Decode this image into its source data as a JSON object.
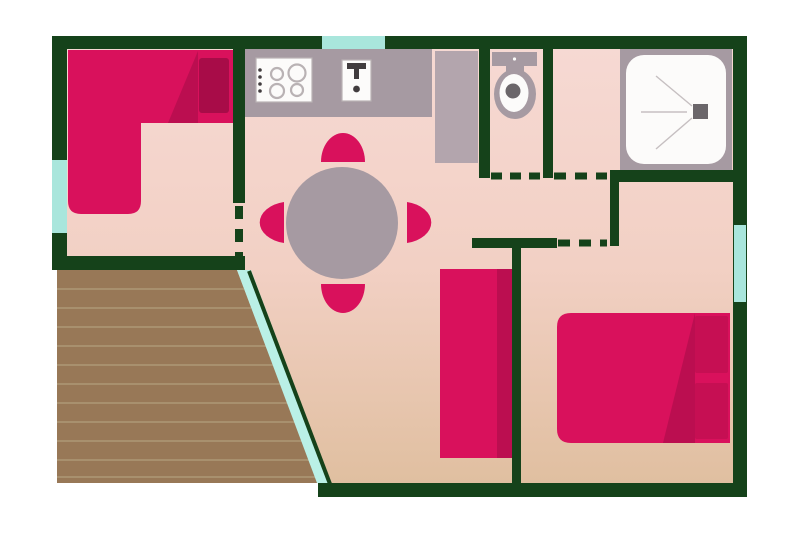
{
  "page": {
    "kind": "floor-plan-illustration"
  },
  "palette": {
    "background": "#ffffff",
    "wall": "#15421a",
    "floor_top": "#f6d9d3",
    "floor_mid": "#f2d0c4",
    "floor_bottom": "#e0bfa0",
    "window_teal": "#a9e6dc",
    "terrace_edge_teal": "#baf0e6",
    "terrace_wood": "#987857",
    "terrace_plank_line": "#a8906e",
    "furniture_primary": "#d9115c",
    "furniture_shade": "#bb0e50",
    "furniture_dark": "#a80c48",
    "pillow_dark": "#c60f53",
    "fixture_gray": "#a69aa2",
    "appliance_gray": "#b3a5ad",
    "fixture_white": "#fcfbfa",
    "fixture_outline": "#b9b2b4",
    "fixture_dark": "#413c3e",
    "drain_gray": "#6b666a",
    "shower_line": "#c6bfc1"
  },
  "plan": {
    "rooms": [
      {
        "name": "bedroom-left"
      },
      {
        "name": "kitchen-living-dining"
      },
      {
        "name": "toilet-room"
      },
      {
        "name": "shower-room"
      },
      {
        "name": "bedroom-right"
      },
      {
        "name": "terrace"
      }
    ],
    "furniture": [
      {
        "name": "corner-sofa-bed"
      },
      {
        "name": "wardrobe"
      },
      {
        "name": "double-bed"
      },
      {
        "name": "dining-table"
      },
      {
        "name": "chairs",
        "count": 4
      }
    ],
    "fixtures": [
      {
        "name": "stove"
      },
      {
        "name": "sink"
      },
      {
        "name": "toilet"
      },
      {
        "name": "shower"
      }
    ],
    "openings": {
      "doorways_dashed": 4,
      "windows": 3
    }
  }
}
